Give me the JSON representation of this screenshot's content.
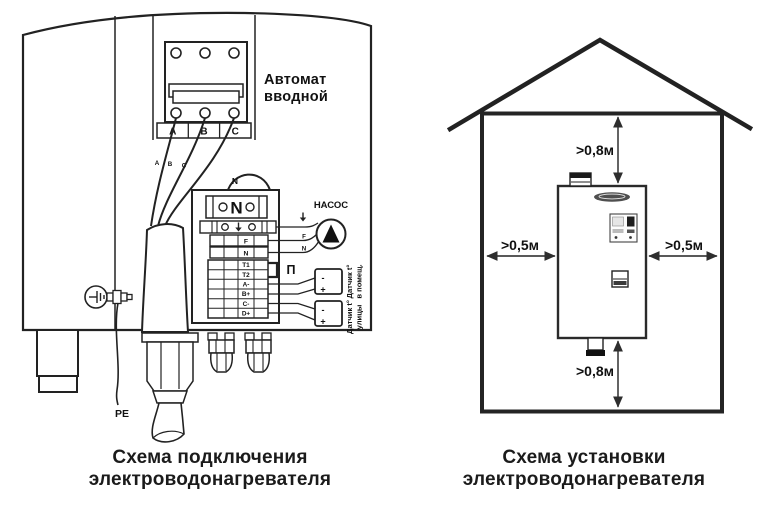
{
  "ink": "#222222",
  "left": {
    "caption": [
      "Схема подключения",
      "электроводонагревателя"
    ],
    "breaker_label": [
      "Автомат",
      "вводной"
    ],
    "phases": [
      "A",
      "B",
      "C"
    ],
    "phase_wires": [
      "А",
      "В",
      "С"
    ],
    "neutral": "N",
    "block": {
      "n": "N",
      "rows": [
        "F",
        "N",
        "T1",
        "T2",
        "A-",
        "B+",
        "C-",
        "D+"
      ]
    },
    "jumper": "П",
    "pump": {
      "title": "НАСОС",
      "f": "F",
      "n": "N"
    },
    "sensors": [
      {
        "minus": "-",
        "plus": "+",
        "line1": "Датчик t°",
        "line2": "в помещ."
      },
      {
        "minus": "-",
        "plus": "+",
        "line1": "Датчик t°",
        "line2": "улицы"
      }
    ],
    "pe": "PE"
  },
  "right": {
    "caption": [
      "Схема установки",
      "электроводонагревателя"
    ],
    "clearance_top": ">0,8м",
    "clearance_bottom": ">0,8м",
    "clearance_left": ">0,5м",
    "clearance_right": ">0,5м"
  }
}
